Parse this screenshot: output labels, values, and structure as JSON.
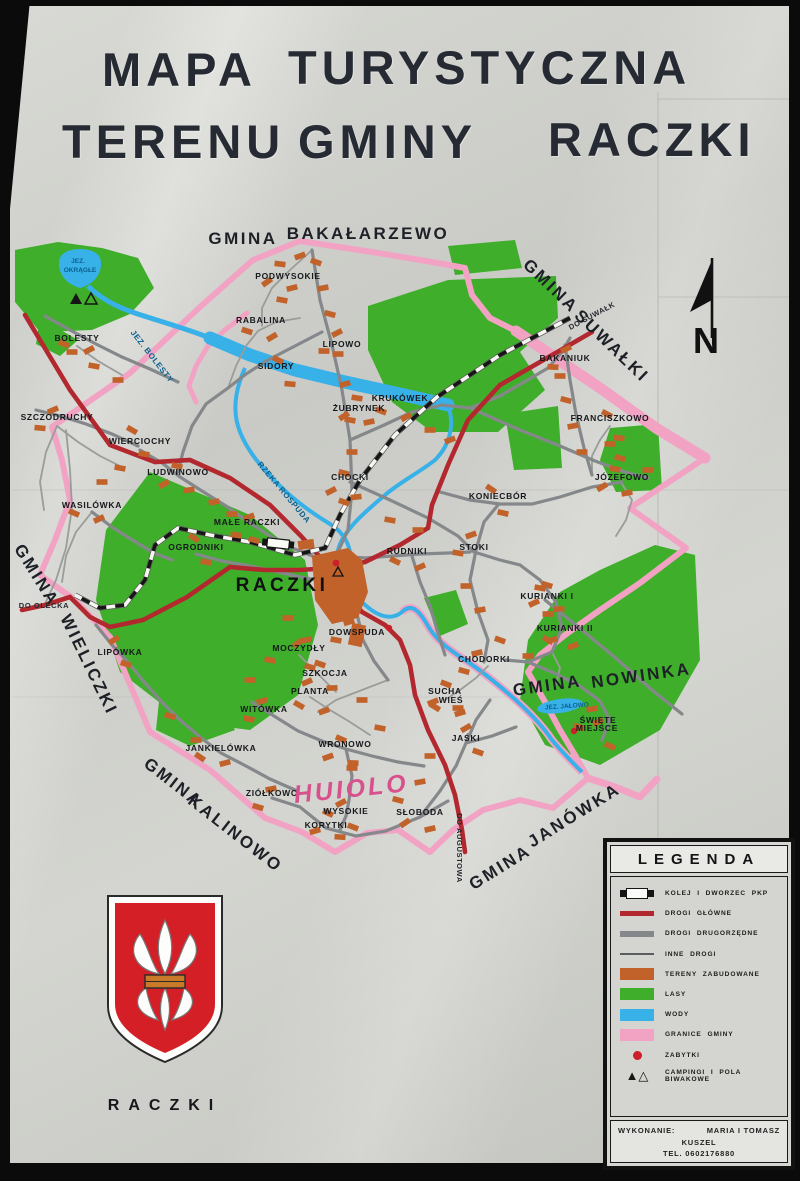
{
  "title": {
    "l1a": "MAPA",
    "l1b": "TURYSTYCZNA",
    "l2a": "TERENU",
    "l2b": "GMINY",
    "l2c": "RACZKI"
  },
  "compass": {
    "label": "N"
  },
  "colors": {
    "forest": "#3fae2a",
    "water": "#38b0e8",
    "boundary": "#f2a3c4",
    "road_main": "#b2282e",
    "road_secondary": "#85888b",
    "built_up": "#c2622b",
    "monument": "#cc1f2a"
  },
  "map": {
    "labels": [
      {
        "text": "GMINA",
        "x": 243,
        "y": 244,
        "r": 0,
        "c": "gmina"
      },
      {
        "text": "BAKAŁARZEWO",
        "x": 368,
        "y": 239,
        "r": 0,
        "c": "gmina"
      },
      {
        "text": "GMINA",
        "x": 547,
        "y": 290,
        "r": 44,
        "c": "gmina"
      },
      {
        "text": "SUWAŁKI",
        "x": 608,
        "y": 350,
        "r": 44,
        "c": "gmina"
      },
      {
        "text": "GMINA",
        "x": 548,
        "y": 691,
        "r": -8,
        "c": "gmina"
      },
      {
        "text": "NOWINKA",
        "x": 642,
        "y": 681,
        "r": -8,
        "c": "gmina"
      },
      {
        "text": "GMINA",
        "x": 32,
        "y": 578,
        "r": 58,
        "c": "gmina"
      },
      {
        "text": "WIELICZKI",
        "x": 84,
        "y": 667,
        "r": 64,
        "c": "gmina"
      },
      {
        "text": "GMINA",
        "x": 170,
        "y": 787,
        "r": 38,
        "c": "gmina"
      },
      {
        "text": "KALINOWO",
        "x": 232,
        "y": 838,
        "r": 38,
        "c": "gmina"
      },
      {
        "text": "GMINA",
        "x": 503,
        "y": 872,
        "r": -32,
        "c": "gmina"
      },
      {
        "text": "JANÓWKA",
        "x": 577,
        "y": 820,
        "r": -32,
        "c": "gmina"
      },
      {
        "text": "DO SUWAŁK",
        "x": 593,
        "y": 318,
        "r": -28,
        "c": "roadlbl"
      },
      {
        "text": "DO OLECKA",
        "x": 44,
        "y": 608,
        "r": 0,
        "c": "roadlbl"
      },
      {
        "text": "DO AUGUSTOWA",
        "x": 457,
        "y": 848,
        "r": 90,
        "c": "roadlbl"
      },
      {
        "text": "JEZ.",
        "x": 78,
        "y": 263,
        "r": 0,
        "c": "watersm"
      },
      {
        "text": "OKRĄGŁE",
        "x": 80,
        "y": 272,
        "r": 0,
        "c": "watersm"
      },
      {
        "text": "JEZ. BOLESTY",
        "x": 150,
        "y": 358,
        "r": 52,
        "c": "waterlbl"
      },
      {
        "text": "RZEKA ROSPUDA",
        "x": 282,
        "y": 494,
        "r": 50,
        "c": "waterlbl"
      },
      {
        "text": "JEZ. JAŁOWO",
        "x": 567,
        "y": 708,
        "r": -4,
        "c": "watersm"
      },
      {
        "text": "RACZKI",
        "x": 282,
        "y": 591,
        "r": 0,
        "c": "town"
      },
      {
        "text": "PODWYSOKIE",
        "x": 288,
        "y": 279,
        "r": 0,
        "c": "vil"
      },
      {
        "text": "RABALINA",
        "x": 261,
        "y": 323,
        "r": 0,
        "c": "vil"
      },
      {
        "text": "LIPOWO",
        "x": 342,
        "y": 347,
        "r": 0,
        "c": "vil"
      },
      {
        "text": "SIDORY",
        "x": 276,
        "y": 369,
        "r": 0,
        "c": "vil"
      },
      {
        "text": "ŻUBRYNEK",
        "x": 359,
        "y": 411,
        "r": 0,
        "c": "vil"
      },
      {
        "text": "KRUKÓWEK",
        "x": 400,
        "y": 401,
        "r": 0,
        "c": "vil"
      },
      {
        "text": "BAKANIUK",
        "x": 565,
        "y": 361,
        "r": 0,
        "c": "vil"
      },
      {
        "text": "FRANCISZKOWO",
        "x": 610,
        "y": 421,
        "r": 0,
        "c": "vil"
      },
      {
        "text": "JÓZEFOWO",
        "x": 622,
        "y": 480,
        "r": 0,
        "c": "vil"
      },
      {
        "text": "BOLESTY",
        "x": 77,
        "y": 341,
        "r": 0,
        "c": "vil"
      },
      {
        "text": "SZCZODRUCHY",
        "x": 57,
        "y": 420,
        "r": 0,
        "c": "vil"
      },
      {
        "text": "WIERCIOCHY",
        "x": 140,
        "y": 444,
        "r": 0,
        "c": "vil"
      },
      {
        "text": "LUDWINOWO",
        "x": 178,
        "y": 475,
        "r": 0,
        "c": "vil"
      },
      {
        "text": "WASILÓWKA",
        "x": 92,
        "y": 508,
        "r": 0,
        "c": "vil"
      },
      {
        "text": "MAŁE RACZKI",
        "x": 247,
        "y": 525,
        "r": 0,
        "c": "vil"
      },
      {
        "text": "OGRODNIKI",
        "x": 196,
        "y": 550,
        "r": 0,
        "c": "vil"
      },
      {
        "text": "CHOCKI",
        "x": 350,
        "y": 480,
        "r": 0,
        "c": "vil"
      },
      {
        "text": "RUDNIKI",
        "x": 407,
        "y": 554,
        "r": 0,
        "c": "vil"
      },
      {
        "text": "STOKI",
        "x": 474,
        "y": 550,
        "r": 0,
        "c": "vil"
      },
      {
        "text": "KONIECBÓR",
        "x": 498,
        "y": 499,
        "r": 0,
        "c": "vil"
      },
      {
        "text": "KURIANKI I",
        "x": 547,
        "y": 599,
        "r": 0,
        "c": "vil"
      },
      {
        "text": "KURIANKI II",
        "x": 565,
        "y": 631,
        "r": 0,
        "c": "vil"
      },
      {
        "text": "DOWSPUDA",
        "x": 357,
        "y": 635,
        "r": 0,
        "c": "vil"
      },
      {
        "text": "MOCZYDŁY",
        "x": 299,
        "y": 651,
        "r": 0,
        "c": "vil"
      },
      {
        "text": "SZKOCJA",
        "x": 325,
        "y": 676,
        "r": 0,
        "c": "vil"
      },
      {
        "text": "PLANTA",
        "x": 310,
        "y": 694,
        "r": 0,
        "c": "vil"
      },
      {
        "text": "WITÓWKA",
        "x": 264,
        "y": 712,
        "r": 0,
        "c": "vil"
      },
      {
        "text": "LIPÓWKA",
        "x": 120,
        "y": 655,
        "r": 0,
        "c": "vil"
      },
      {
        "text": "SUCHA",
        "x": 445,
        "y": 694,
        "r": 0,
        "c": "vil"
      },
      {
        "text": "WIEŚ",
        "x": 451,
        "y": 703,
        "r": 0,
        "c": "vil"
      },
      {
        "text": "CHODORKI",
        "x": 484,
        "y": 662,
        "r": 0,
        "c": "vil"
      },
      {
        "text": "JAŚKI",
        "x": 466,
        "y": 741,
        "r": 0,
        "c": "vil"
      },
      {
        "text": "WRONOWO",
        "x": 345,
        "y": 747,
        "r": 0,
        "c": "vil"
      },
      {
        "text": "JANKIELÓWKA",
        "x": 221,
        "y": 751,
        "r": 0,
        "c": "vil"
      },
      {
        "text": "ZIÓŁKOWO",
        "x": 272,
        "y": 796,
        "r": 0,
        "c": "vil"
      },
      {
        "text": "WYSOKIE",
        "x": 346,
        "y": 814,
        "r": 0,
        "c": "vil"
      },
      {
        "text": "KORYTKI",
        "x": 326,
        "y": 828,
        "r": 0,
        "c": "vil"
      },
      {
        "text": "SŁOBODA",
        "x": 420,
        "y": 815,
        "r": 0,
        "c": "vil"
      },
      {
        "text": "ŚWIĘTE",
        "x": 598,
        "y": 723,
        "r": 0,
        "c": "vil"
      },
      {
        "text": "MIEJSCE",
        "x": 597,
        "y": 731,
        "r": 0,
        "c": "vil"
      },
      {
        "text": "HUIOLO",
        "x": 352,
        "y": 797,
        "r": -6,
        "c": "graffiti"
      },
      {
        "text": "N",
        "x": 706,
        "y": 353,
        "r": 0,
        "c": "compass"
      }
    ]
  },
  "legend": {
    "title": "LEGENDA",
    "items": [
      {
        "label": "KOLEJ I DWORZEC PKP",
        "symbol": "rail",
        "color": "#151515"
      },
      {
        "label": "DROGI GŁÓWNE",
        "symbol": "bar-road",
        "color": "#b2282e"
      },
      {
        "label": "DROGI DRUGORZĘDNE",
        "symbol": "bar-road",
        "color": "#85888b"
      },
      {
        "label": "INNE DROGI",
        "symbol": "bar-thin",
        "color": "#5a5d60"
      },
      {
        "label": "TERENY ZABUDOWANE",
        "symbol": "swatch",
        "color": "#c2622b"
      },
      {
        "label": "LASY",
        "symbol": "swatch",
        "color": "#3fae2a"
      },
      {
        "label": "WODY",
        "symbol": "swatch",
        "color": "#38b0e8"
      },
      {
        "label": "GRANICE GMINY",
        "symbol": "swatch",
        "color": "#f2a3c4"
      },
      {
        "label": "ZABYTKI",
        "symbol": "dot",
        "color": "#cc1f2a"
      },
      {
        "label": "CAMPINGI I POLA BIWAKOWE",
        "symbol": "triangles",
        "color": "#151515"
      }
    ],
    "credit": {
      "label": "WYKONANIE:",
      "name": "MARIA I TOMASZ",
      "name2": "KUSZEL",
      "tel": "TEL. 0602176880"
    }
  },
  "crest": {
    "caption": "RACZKI"
  }
}
